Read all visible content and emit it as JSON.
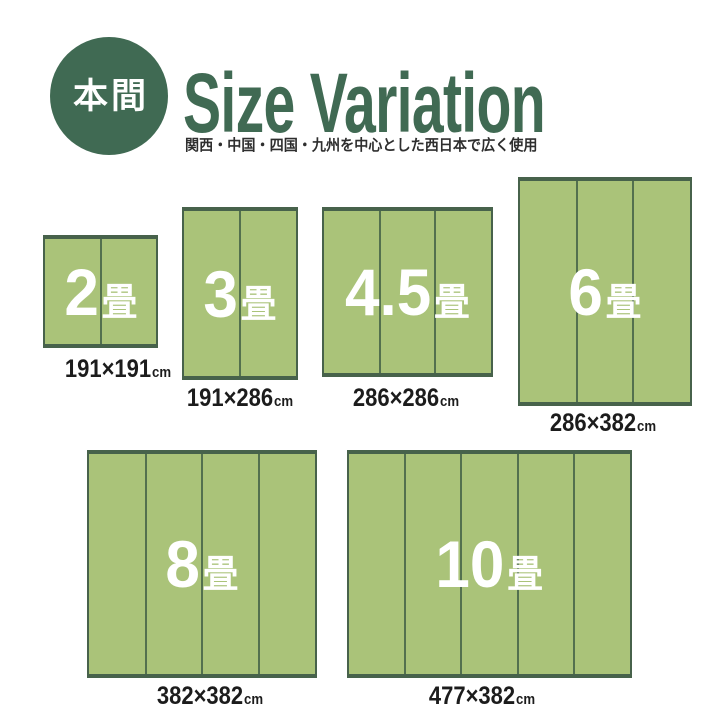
{
  "header": {
    "badge": "本間",
    "title": "Size Variation",
    "subtitle": "関西・中国・四国・九州を中心とした西日本で広く使用"
  },
  "colors": {
    "accent_green": "#406A53",
    "mat_fill": "#AAC379",
    "mat_border": "#47624B",
    "label_text": "#1C1C1C"
  },
  "mats": [
    {
      "label_number": "2",
      "label_unit": "畳",
      "size": "191×191",
      "size_unit": "cm",
      "width_cm": 191,
      "height_cm": 191,
      "panels": 2
    },
    {
      "label_number": "3",
      "label_unit": "畳",
      "size": "191×286",
      "size_unit": "cm",
      "width_cm": 191,
      "height_cm": 286,
      "panels": 2
    },
    {
      "label_number": "4.5",
      "label_unit": "畳",
      "size": "286×286",
      "size_unit": "cm",
      "width_cm": 286,
      "height_cm": 286,
      "panels": 3
    },
    {
      "label_number": "6",
      "label_unit": "畳",
      "size": "286×382",
      "size_unit": "cm",
      "width_cm": 286,
      "height_cm": 382,
      "panels": 3
    },
    {
      "label_number": "8",
      "label_unit": "畳",
      "size": "382×382",
      "size_unit": "cm",
      "width_cm": 382,
      "height_cm": 382,
      "panels": 4
    },
    {
      "label_number": "10",
      "label_unit": "畳",
      "size": "477×382",
      "size_unit": "cm",
      "width_cm": 477,
      "height_cm": 382,
      "panels": 5
    }
  ]
}
